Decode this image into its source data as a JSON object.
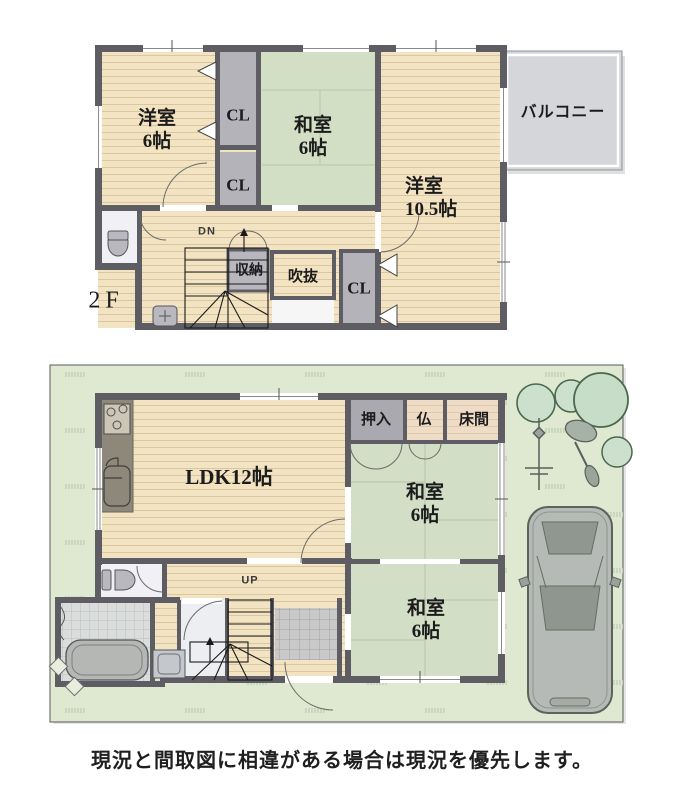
{
  "caption": "現況と間取図に相違がある場合は現況を優先します。",
  "floor2": {
    "floor_label": "2F",
    "balcony": "バルコニー",
    "rooms": {
      "youshitsu6": {
        "name": "洋室",
        "size": "6帖"
      },
      "washitsu6": {
        "name": "和室",
        "size": "6帖"
      },
      "youshitsu105": {
        "name": "洋室",
        "size": "10.5帖"
      },
      "cl_top": "CL",
      "cl_mid": "CL",
      "cl_right": "CL",
      "storage": "収納",
      "void": "吹抜",
      "stairs_dir": "DN"
    }
  },
  "floor1": {
    "rooms": {
      "ldk": "LDK12帖",
      "oshiire": "押入",
      "butsudan": "仏",
      "tokonoma": "床間",
      "washitsu_north": {
        "name": "和室",
        "size": "6帖"
      },
      "washitsu_south": {
        "name": "和室",
        "size": "6帖"
      },
      "stairs_dir": "UP"
    }
  },
  "colors": {
    "wall": "#5e5d63",
    "wood_floor": "#f2e3c2",
    "tatami": "#d3dfc5",
    "closet": "#b4b3b9",
    "balcony": "#d4d6d9",
    "site_green": "#dfe8d1",
    "alcove_wood": "#eedcc6"
  },
  "icons": {
    "toilet": "toilet-icon",
    "sink": "sink-icon",
    "stove": "stove-icon",
    "bathtub": "bathtub-icon",
    "washing_machine": "washing-machine-icon",
    "car": "car-icon",
    "tree": "tree-icon",
    "laundry_pole": "laundry-pole-icon",
    "bicycle": "bicycle-icon",
    "stairs": "stairs-icon"
  }
}
